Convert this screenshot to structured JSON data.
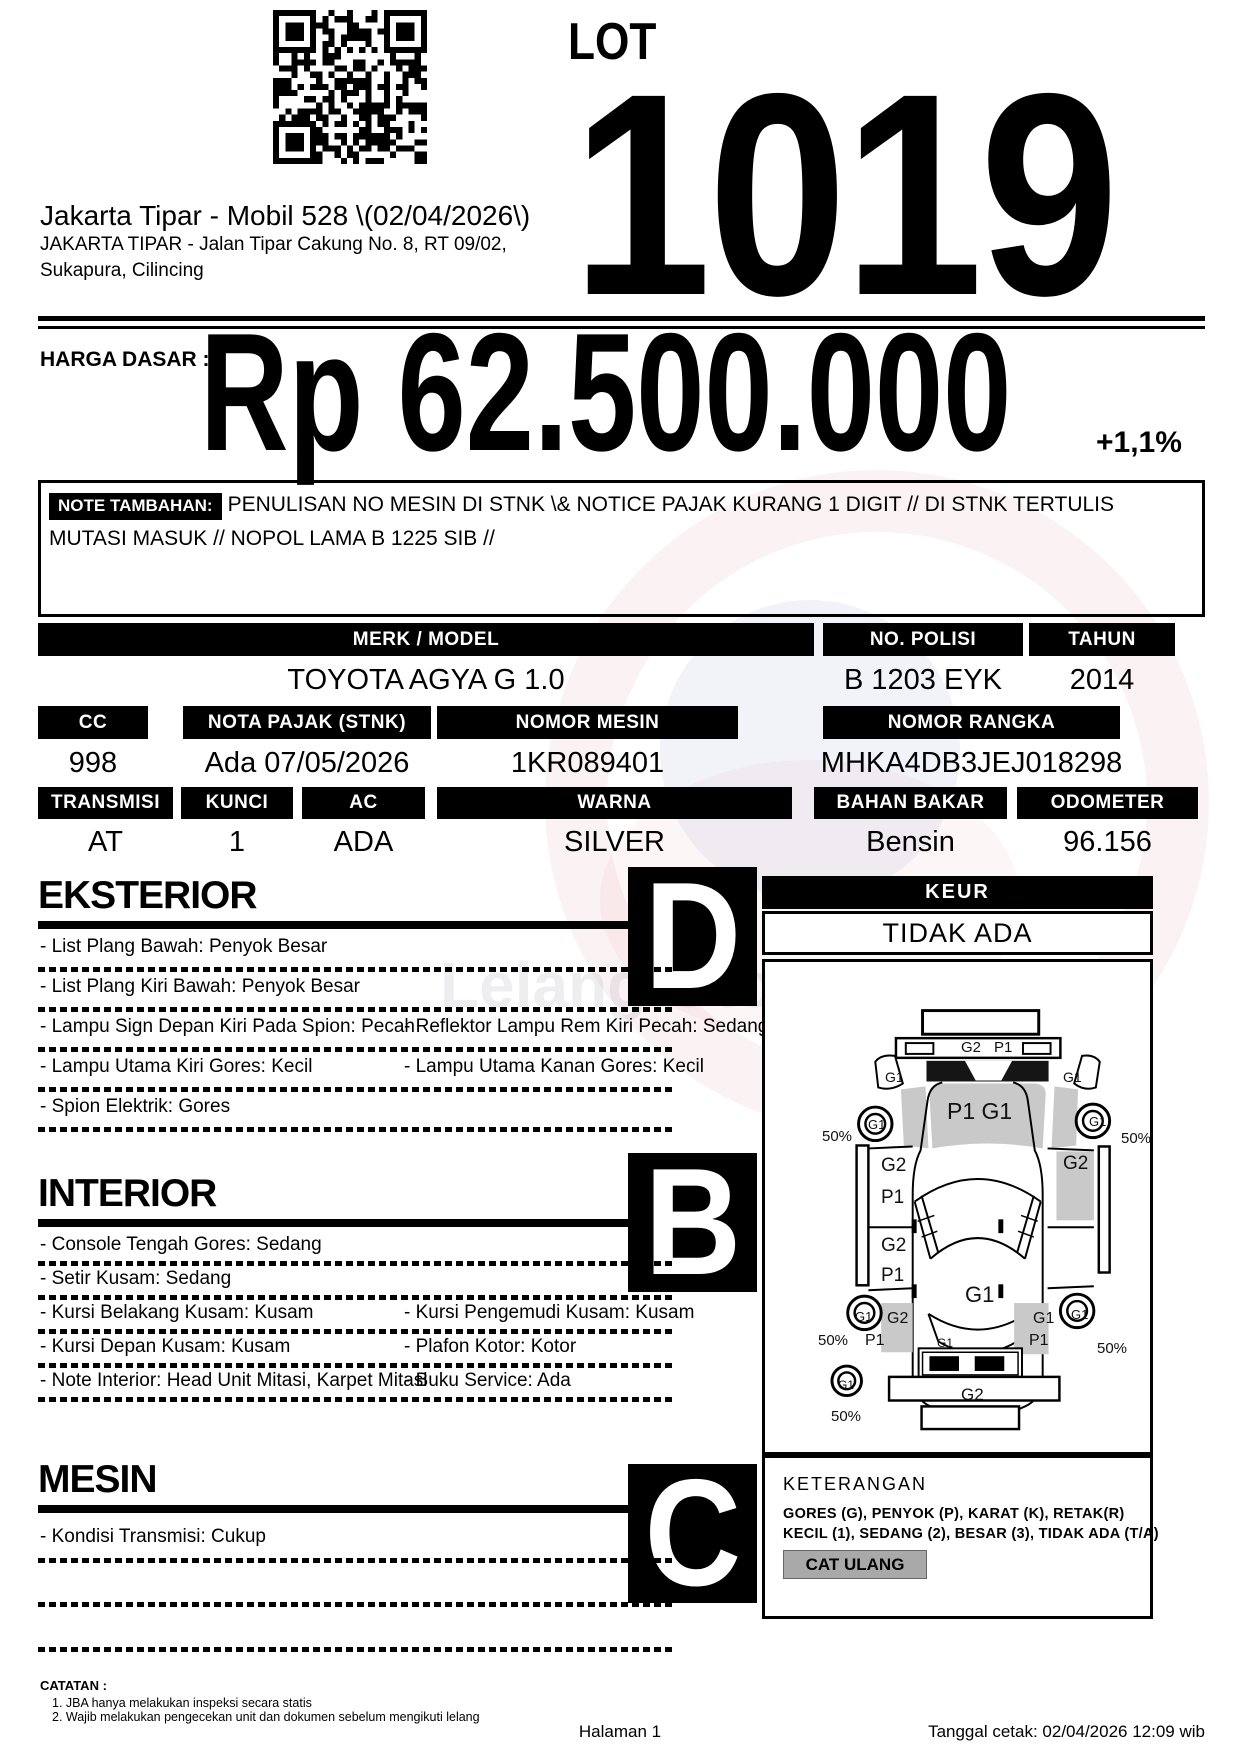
{
  "lot": {
    "label": "LOT",
    "number": "1019"
  },
  "header": {
    "title": "Jakarta Tipar - Mobil 528 \\(02/04/2026\\)",
    "address_line1": "JAKARTA TIPAR - Jalan Tipar Cakung No. 8, RT 09/02,",
    "address_line2": "Sukapura, Cilincing"
  },
  "price": {
    "label": "HARGA DASAR :",
    "value": "Rp 62.500.000",
    "increment": "+1,1%"
  },
  "note": {
    "label": "NOTE TAMBAHAN:",
    "text": "PENULISAN NO MESIN DI STNK \\& NOTICE PAJAK KURANG 1 DIGIT // DI STNK TERTULIS MUTASI MASUK // NOPOL LAMA B 1225 SIB //"
  },
  "specs": {
    "row1": [
      {
        "label": "MERK / MODEL",
        "value": "TOYOTA AGYA G 1.0"
      },
      {
        "label": "NO. POLISI",
        "value": "B 1203 EYK"
      },
      {
        "label": "TAHUN",
        "value": "2014"
      }
    ],
    "row2": [
      {
        "label": "CC",
        "value": "998"
      },
      {
        "label": "NOTA PAJAK (STNK)",
        "value": "Ada 07/05/2026"
      },
      {
        "label": "NOMOR MESIN",
        "value": "1KR089401"
      },
      {
        "label": "NOMOR RANGKA",
        "value": "MHKA4DB3JEJ018298"
      }
    ],
    "row3": [
      {
        "label": "TRANSMISI",
        "value": "AT"
      },
      {
        "label": "KUNCI",
        "value": "1"
      },
      {
        "label": "AC",
        "value": "ADA"
      },
      {
        "label": "WARNA",
        "value": "SILVER"
      },
      {
        "label": "BAHAN BAKAR",
        "value": "Bensin"
      },
      {
        "label": "ODOMETER",
        "value": "96.156"
      }
    ]
  },
  "sections": [
    {
      "title": "EKSTERIOR",
      "grade": "D",
      "items": [
        {
          "left": "- List Plang Bawah: Penyok Besar",
          "right": ""
        },
        {
          "left": "- List Plang Kiri Bawah: Penyok Besar",
          "right": ""
        },
        {
          "left": "- Lampu Sign Depan Kiri Pada Spion: Pecah",
          "right": "- Reflektor Lampu Rem Kiri Pecah: Sedang"
        },
        {
          "left": "- Lampu Utama Kiri Gores: Kecil",
          "right": "- Lampu Utama Kanan Gores: Kecil"
        },
        {
          "left": "- Spion Elektrik: Gores",
          "right": ""
        }
      ]
    },
    {
      "title": "INTERIOR",
      "grade": "B",
      "items": [
        {
          "left": "- Console Tengah Gores: Sedang",
          "right": ""
        },
        {
          "left": "- Setir Kusam: Sedang",
          "right": ""
        },
        {
          "left": "- Kursi Belakang Kusam: Kusam",
          "right": "- Kursi Pengemudi Kusam: Kusam"
        },
        {
          "left": "- Kursi Depan Kusam: Kusam",
          "right": "- Plafon Kotor: Kotor"
        },
        {
          "left": "- Note Interior: Head Unit Mitasi, Karpet Mitasi",
          "right": "- Buku Service: Ada"
        }
      ]
    },
    {
      "title": "MESIN",
      "grade": "C",
      "items": [
        {
          "left": "- Kondisi Transmisi: Cukup",
          "right": ""
        },
        {
          "left": "",
          "right": ""
        },
        {
          "left": "",
          "right": ""
        }
      ]
    }
  ],
  "keur": {
    "label": "KEUR",
    "value": "TIDAK ADA"
  },
  "diagram_labels": [
    {
      "t": "G2",
      "x": 196,
      "y": 78,
      "s": 15
    },
    {
      "t": "P1",
      "x": 229,
      "y": 78,
      "s": 15
    },
    {
      "t": "G1",
      "x": 120,
      "y": 108,
      "s": 14
    },
    {
      "t": "G1",
      "x": 298,
      "y": 108,
      "s": 14
    },
    {
      "t": "P1 G1",
      "x": 182,
      "y": 138,
      "s": 23
    },
    {
      "t": "G1",
      "x": 103,
      "y": 156,
      "s": 13
    },
    {
      "t": "G1",
      "x": 324,
      "y": 153,
      "s": 13
    },
    {
      "t": "50%",
      "x": 57,
      "y": 167,
      "s": 15
    },
    {
      "t": "50%",
      "x": 356,
      "y": 169,
      "s": 15
    },
    {
      "t": "G2",
      "x": 116,
      "y": 194,
      "s": 19
    },
    {
      "t": "P1",
      "x": 116,
      "y": 226,
      "s": 19
    },
    {
      "t": "G2",
      "x": 298,
      "y": 192,
      "s": 19
    },
    {
      "t": "G2",
      "x": 116,
      "y": 274,
      "s": 19
    },
    {
      "t": "P1",
      "x": 116,
      "y": 304,
      "s": 19
    },
    {
      "t": "G1",
      "x": 200,
      "y": 322,
      "s": 22
    },
    {
      "t": "G2",
      "x": 122,
      "y": 349,
      "s": 16
    },
    {
      "t": "P1",
      "x": 100,
      "y": 371,
      "s": 16
    },
    {
      "t": "G1",
      "x": 268,
      "y": 349,
      "s": 16
    },
    {
      "t": "P1",
      "x": 264,
      "y": 371,
      "s": 16
    },
    {
      "t": "G1",
      "x": 90,
      "y": 348,
      "s": 13
    },
    {
      "t": "G1",
      "x": 306,
      "y": 346,
      "s": 13
    },
    {
      "t": "50%",
      "x": 53,
      "y": 371,
      "s": 15
    },
    {
      "t": "50%",
      "x": 332,
      "y": 379,
      "s": 15
    },
    {
      "t": "G1",
      "x": 172,
      "y": 375,
      "s": 12
    },
    {
      "t": "G2",
      "x": 196,
      "y": 424,
      "s": 17
    },
    {
      "t": "G1",
      "x": 73,
      "y": 417,
      "s": 12
    },
    {
      "t": "50%",
      "x": 66,
      "y": 447,
      "s": 15
    }
  ],
  "keterangan": {
    "title": "KETERANGAN",
    "line1": "GORES (G), PENYOK (P), KARAT (K), RETAK(R)",
    "line2": "KECIL (1), SEDANG (2), BESAR (3), TIDAK ADA (T/A)",
    "badge": "CAT ULANG"
  },
  "footer": {
    "catatan_title": "CATATAN :",
    "notes": [
      "1. JBA hanya melakukan inspeksi secara statis",
      "2. Wajib melakukan pengecekan unit dan dokumen sebelum mengikuti lelang"
    ],
    "page": "Halaman 1",
    "printed": "Tanggal cetak: 02/04/2026 12:09 wib"
  },
  "watermark": {
    "text": "Lelang Otomotif No.1",
    "red": "#c01f2f",
    "blue": "#1d3293"
  }
}
